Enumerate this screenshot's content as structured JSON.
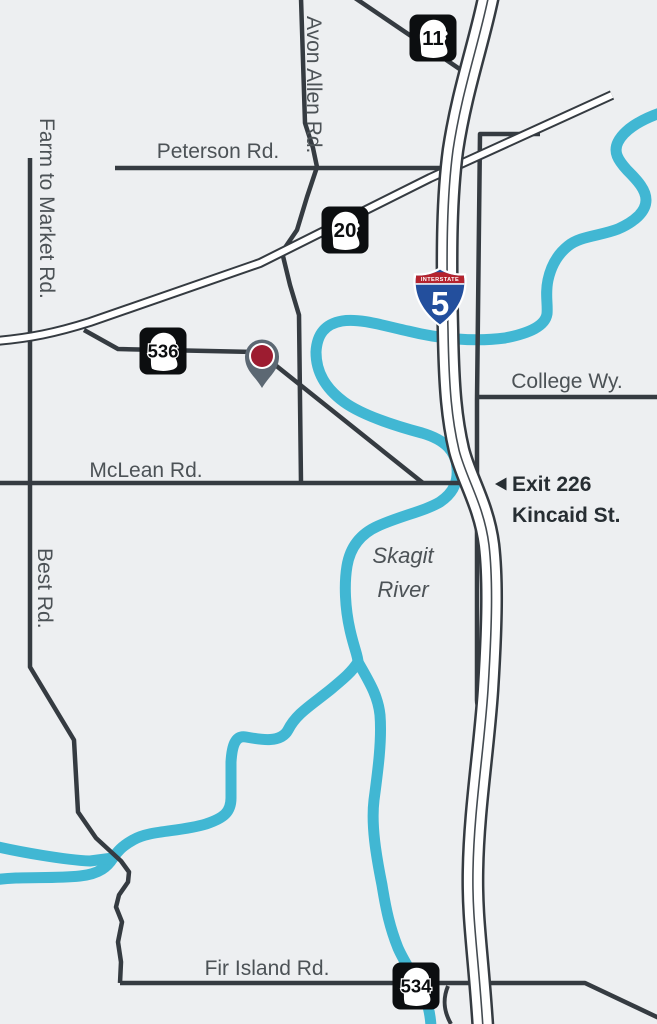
{
  "map": {
    "colors": {
      "background": "#edeff1",
      "road": "#353b41",
      "highway_fill": "#ffffff",
      "river": "#41b7d3",
      "label": "#4c5256",
      "exit_text": "#272e33",
      "shield_black": "#0c0e10",
      "interstate_red": "#b5232e",
      "interstate_blue": "#234f9d",
      "pin_body": "#5c6873",
      "pin_dot": "#9d1c30"
    },
    "road_labels": {
      "peterson": "Peterson Rd.",
      "avon_allen": "Avon Allen Rd.",
      "farm_to_market": "Farm to Market Rd.",
      "college": "College Wy.",
      "mclean": "McLean Rd.",
      "best": "Best Rd.",
      "fir_island": "Fir Island Rd."
    },
    "river_label": {
      "line1": "Skagit",
      "line2": "River"
    },
    "exit_callout": {
      "line1": "Exit 226",
      "line2": "Kincaid St."
    },
    "shields": {
      "wa_11": "11",
      "wa_20": "20",
      "wa_536": "536",
      "wa_534": "534",
      "i5_number": "5",
      "i5_banner": "INTERSTATE"
    }
  }
}
